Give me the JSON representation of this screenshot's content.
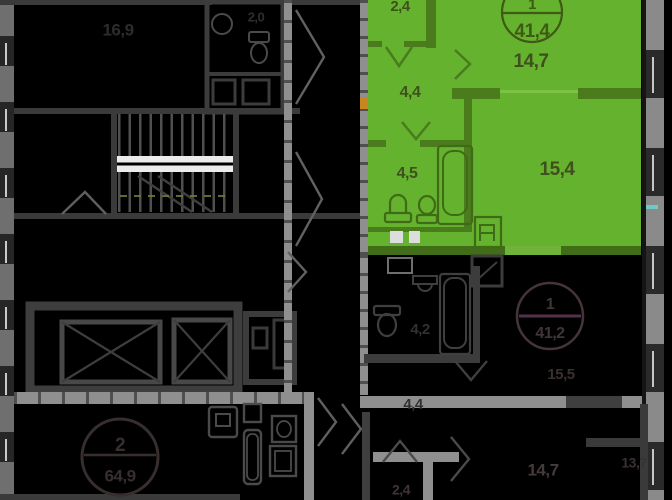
{
  "colors": {
    "background": "#000000",
    "highlight_fill": "#65b22e",
    "highlight_wall": "#4a7c1d",
    "highlight_label": "#3f4f1d",
    "wall_dark": "#3a3a3a",
    "wall_light": "#8f8f8f",
    "stair_landing": "#ececec",
    "accent_orange": "#c8871e",
    "accent_cyan": "#6fc9c9"
  },
  "highlighted_unit": {
    "badge": {
      "type": "1",
      "total_area": "41,4"
    },
    "rooms": {
      "wardrobe": "2,4",
      "living": "14,7",
      "hall": "4,4",
      "bathroom": "4,5",
      "bedroom": "15,4"
    }
  },
  "units": {
    "top_left": {
      "room": "16,9",
      "bathroom": "2,0"
    },
    "bottom_left": {
      "badge": {
        "type": "2",
        "total_area": "64,9"
      }
    },
    "bottom_right": {
      "badge": {
        "type": "1",
        "total_area": "41,2"
      },
      "rooms": {
        "bedroom": "15,5",
        "bathroom": "4,2",
        "hall": "4,4",
        "living": "14,7",
        "wardrobe": "2,4",
        "kitchen": "13,7"
      }
    }
  }
}
